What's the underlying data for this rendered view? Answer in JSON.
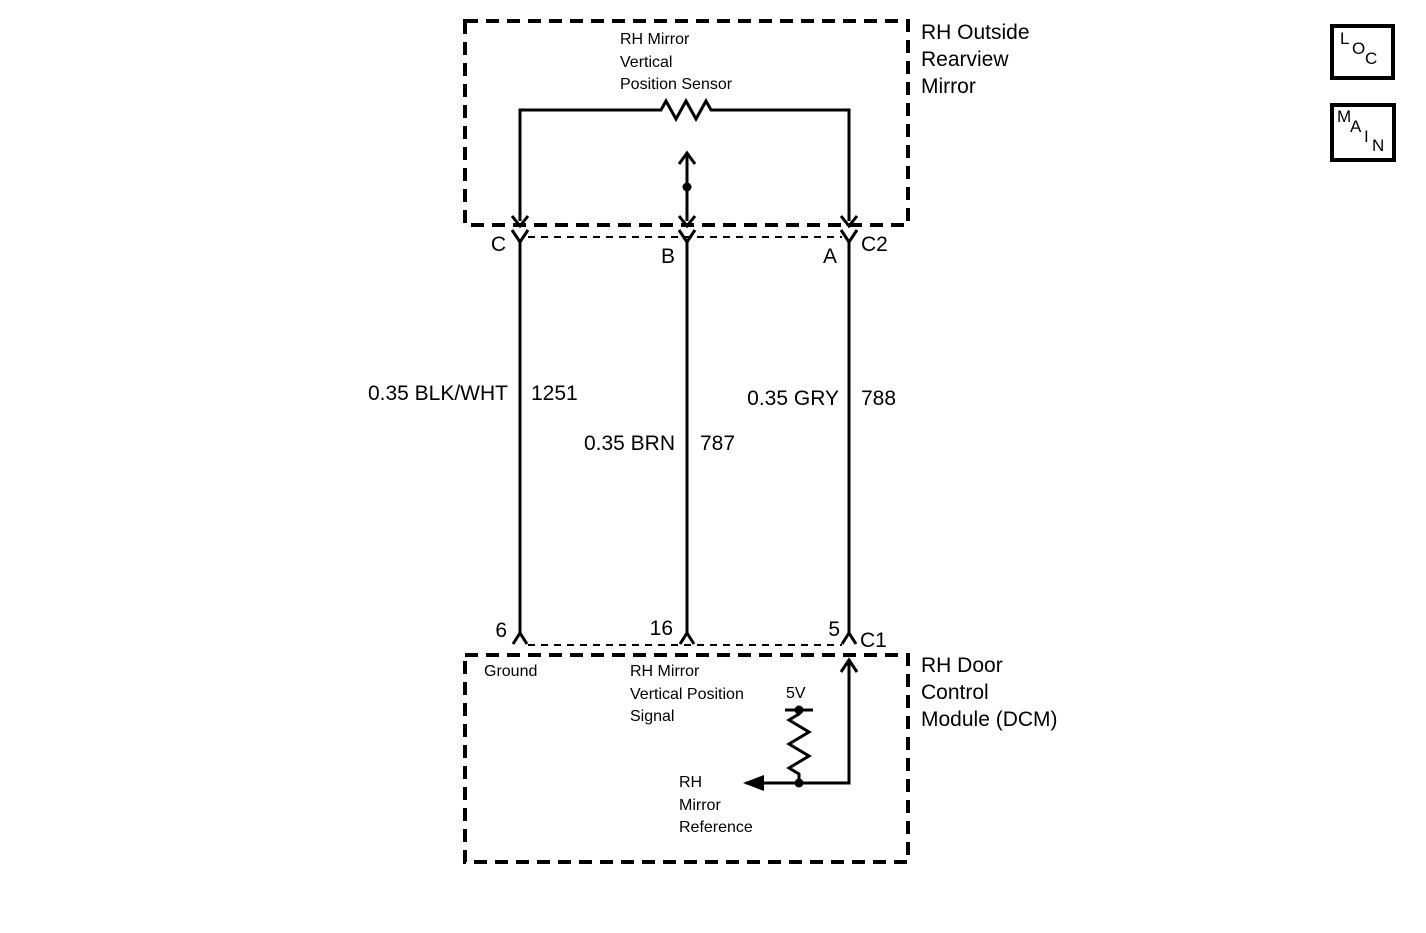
{
  "colors": {
    "line": "#000000",
    "background": "#ffffff"
  },
  "mirror": {
    "box_title_lines": [
      "RH Outside",
      "Rearview",
      "Mirror"
    ],
    "sensor_label_lines": [
      "RH Mirror",
      "Vertical",
      "Position Sensor"
    ],
    "connector_id": "C2",
    "pins": {
      "left": "C",
      "middle": "B",
      "right": "A"
    }
  },
  "wires": {
    "left": {
      "spec": "0.35 BLK/WHT",
      "circuit_number": "1251"
    },
    "middle": {
      "spec": "0.35 BRN",
      "circuit_number": "787"
    },
    "right": {
      "spec": "0.35 GRY",
      "circuit_number": "788"
    }
  },
  "dcm": {
    "box_title_lines": [
      "RH Door",
      "Control",
      "Module (DCM)"
    ],
    "connector_id": "C1",
    "pins": {
      "left": "6",
      "middle": "16",
      "right": "5"
    },
    "functions": {
      "ground": "Ground",
      "signal_lines": [
        "RH Mirror",
        "Vertical Position",
        "Signal"
      ],
      "supply_voltage": "5V",
      "reference_lines": [
        "RH",
        "Mirror",
        "Reference"
      ]
    }
  },
  "nav": {
    "loc_letters": [
      "L",
      "O",
      "C"
    ],
    "main_letters": [
      "M",
      "A",
      "I",
      "N"
    ]
  }
}
